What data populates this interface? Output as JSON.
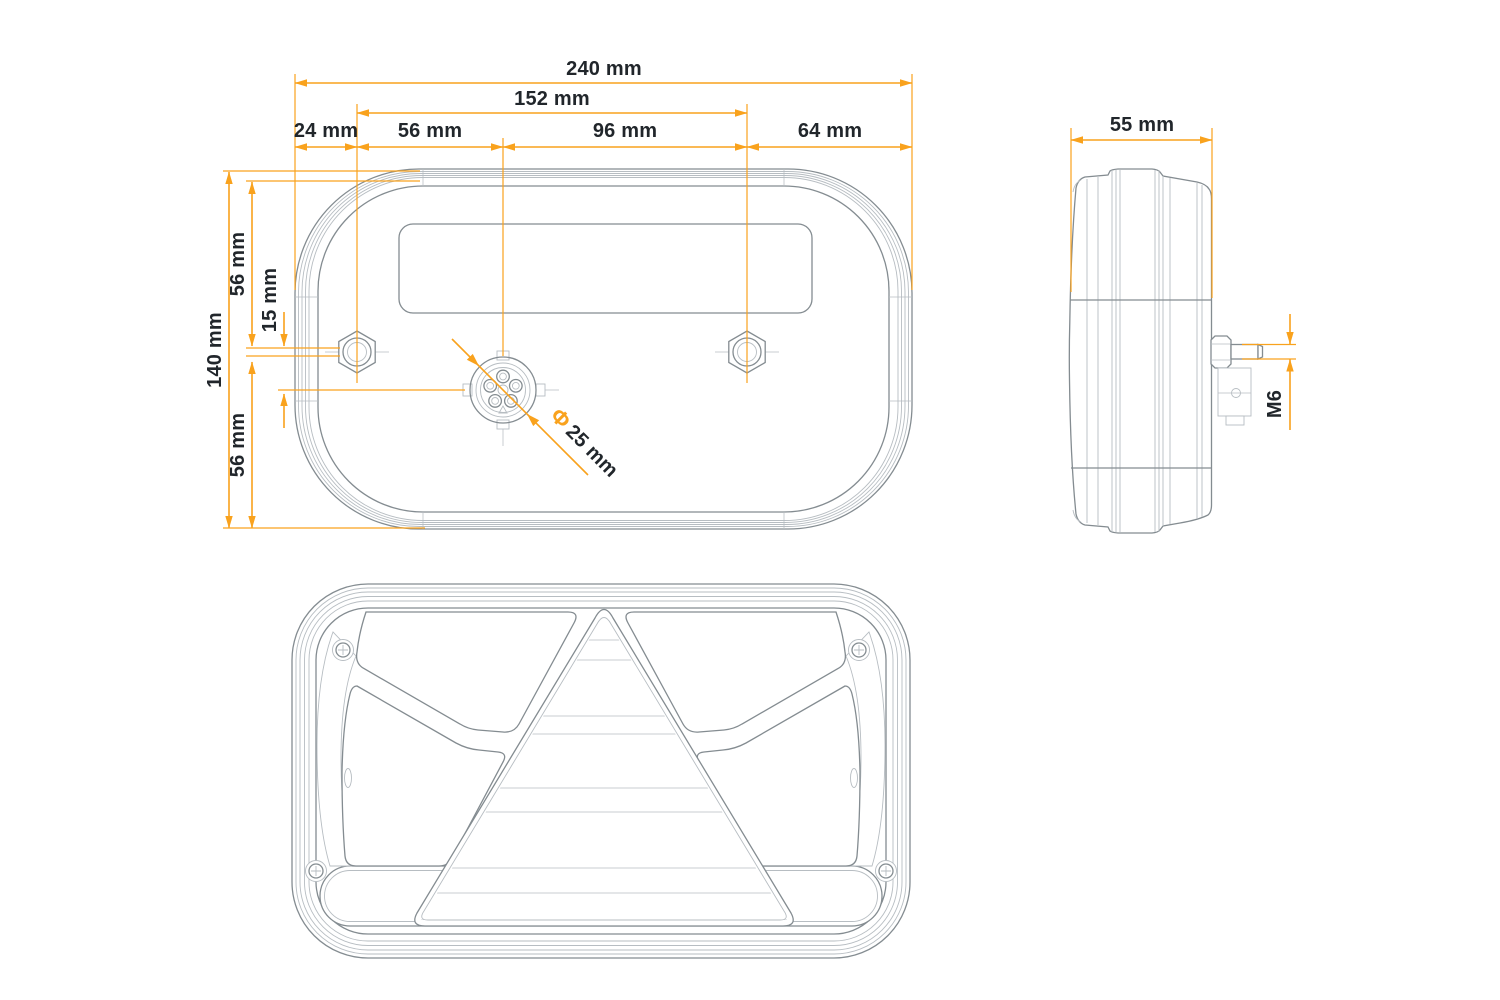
{
  "colors": {
    "dimension": "#F9A21D",
    "outline": "#848C91",
    "detail": "#B7BDC2",
    "hatch": "#C6CBCF",
    "text": "#21262B",
    "background": "#FFFFFF"
  },
  "back_view": {
    "dim_total_width": "240 mm",
    "dim_mount_hole_span": "152 mm",
    "dim_edge_to_left_hole": "24 mm",
    "dim_left_hole_to_connector": "56 mm",
    "dim_connector_to_right_hole": "96 mm",
    "dim_right_hole_to_edge": "64 mm",
    "dim_total_height": "140 mm",
    "dim_top_edge_to_hole": "56 mm",
    "dim_hole_to_connector_offset": "15 mm",
    "dim_connector_to_bottom_edge": "56 mm",
    "connector_diameter_symbol": "Φ",
    "connector_diameter_value": "25 mm"
  },
  "side_view": {
    "dim_depth": "55 mm",
    "dim_mount_stud_thread": "M6"
  }
}
